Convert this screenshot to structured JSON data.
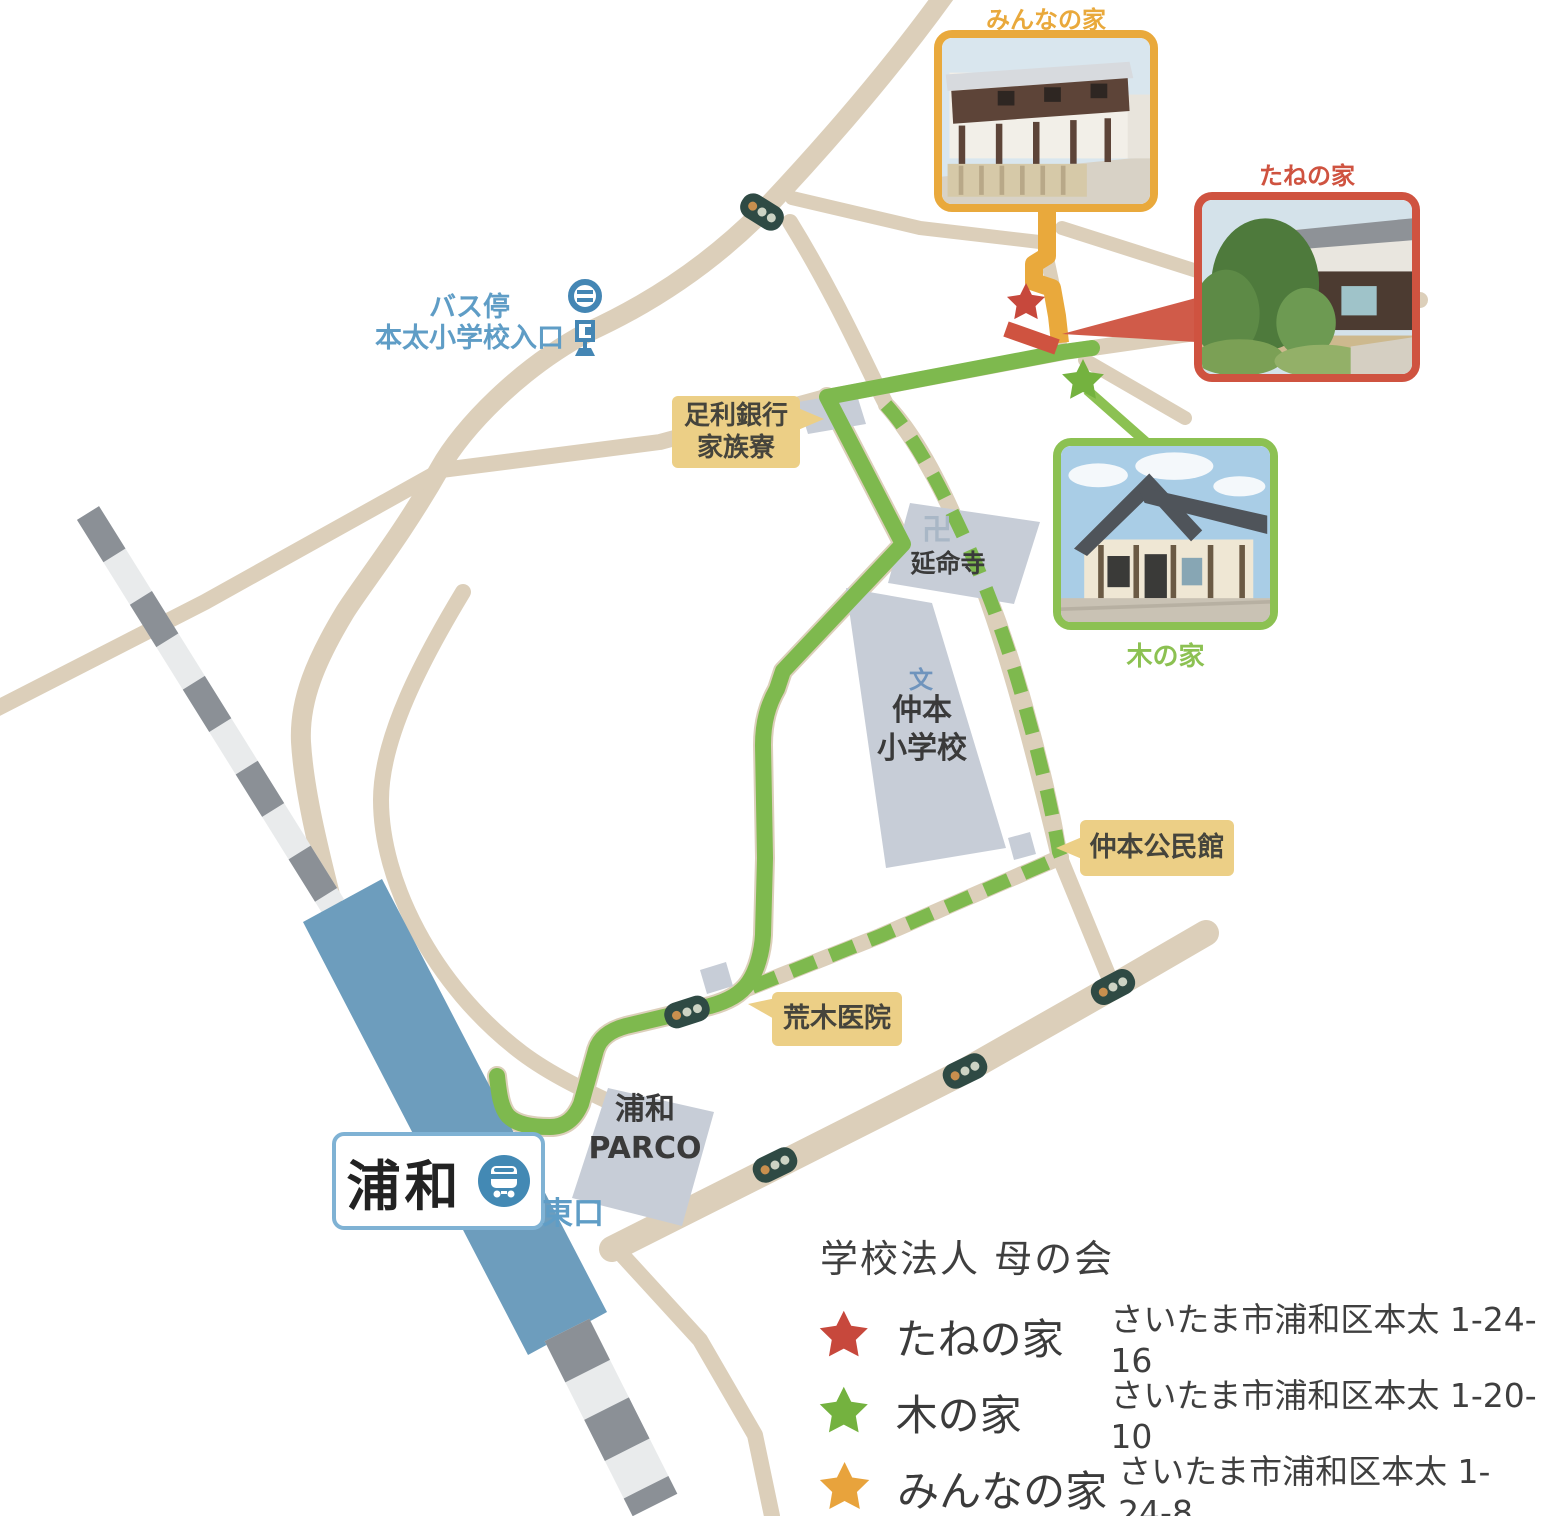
{
  "title": {
    "text": "学校法人 母の会"
  },
  "legend": {
    "items": [
      {
        "label": "たねの家",
        "address": "さいたま市浦和区本太 1-24-16",
        "color": "#c7483c"
      },
      {
        "label": "木の家",
        "address": "さいたま市浦和区本太 1-20-10",
        "color": "#74b23f"
      },
      {
        "label": "みんなの家",
        "address": "さいたま市浦和区本太 1-24-8",
        "color": "#e8a33c"
      }
    ]
  },
  "photos": [
    {
      "label": "みんなの家",
      "border_color": "#e9a93c"
    },
    {
      "label": "たねの家",
      "border_color": "#cf5340"
    },
    {
      "label": "木の家",
      "border_color": "#8cc152"
    }
  ],
  "map_labels": {
    "bus_stop": {
      "line1": "バス停",
      "line2": "本太小学校入口"
    },
    "bank": {
      "line1": "足利銀行",
      "line2": "家族寮"
    },
    "temple": {
      "symbol": "卍",
      "name": "延命寺"
    },
    "school": {
      "symbol": "文",
      "line1": "仲本",
      "line2": "小学校"
    },
    "hall": {
      "name": "仲本公民館"
    },
    "clinic": {
      "name": "荒木医院"
    },
    "parco": {
      "line1": "浦和",
      "line2": "PARCO"
    },
    "station": {
      "name": "浦和",
      "exit": "東口"
    }
  },
  "colors": {
    "road": "#dccfba",
    "route_green": "#7eb94e",
    "route_orange": "#e9a93c",
    "route_red": "#cf5340",
    "railway_dark": "#8b9096",
    "railway_light": "#e9ebec",
    "station_blue": "#6d9dbd",
    "building_gray": "#c7cdd7",
    "label_yellow": "#eccf86",
    "text_blue": "#5f9dc6",
    "text_dark": "#3f3f3f"
  }
}
